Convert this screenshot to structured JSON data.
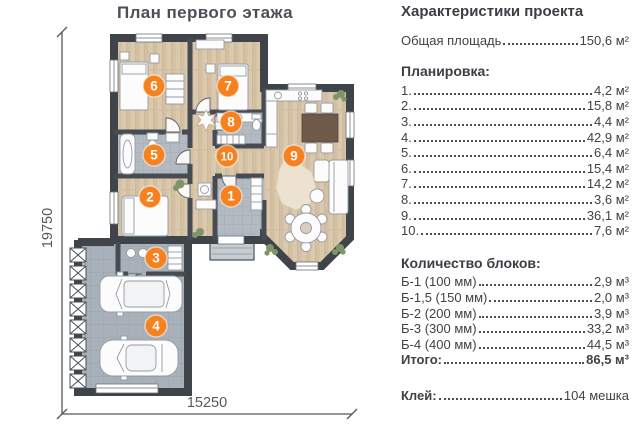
{
  "title": "План первого этажа",
  "dimension_height": "19750",
  "dimension_width": "15250",
  "plan": {
    "rooms": [
      {
        "n": "1",
        "area": "4,2 м²"
      },
      {
        "n": "2",
        "area": "15,8 м²"
      },
      {
        "n": "3",
        "area": "4,4 м²"
      },
      {
        "n": "4",
        "area": "42,9 м²"
      },
      {
        "n": "5",
        "area": "6,4 м²"
      },
      {
        "n": "6",
        "area": "15,4 м²"
      },
      {
        "n": "7",
        "area": "14,2 м²"
      },
      {
        "n": "8",
        "area": "3,6 м²"
      },
      {
        "n": "9",
        "area": "36,1 м²"
      },
      {
        "n": "10",
        "area": "7,6 м²"
      }
    ]
  },
  "specs": {
    "header": "Характеристики проекта",
    "total_area_label": "Общая площадь",
    "total_area_value": "150,6 м²",
    "layout_header": "Планировка:",
    "blocks_header": "Количество блоков:",
    "blocks": [
      {
        "label": "Б-1 (100 мм)",
        "value": "2,9 м³"
      },
      {
        "label": "Б-1,5 (150 мм)",
        "value": "2,0 м³"
      },
      {
        "label": "Б-2 (200 мм)",
        "value": "3,9 м³"
      },
      {
        "label": "Б-3 (300 мм)",
        "value": "33,2 м³"
      },
      {
        "label": "Б-4 (400 мм)",
        "value": "44,5 м³"
      }
    ],
    "totals_label": "Итого:",
    "totals_value": "86,5 м³",
    "glue_label": "Клей:",
    "glue_value": "104 мешка"
  },
  "colors": {
    "accent": "#f5821f",
    "wall": "#3f444b",
    "wood": "#dbc9ae",
    "tile": "#b3bac2",
    "garage_tile": "#a8b1ba",
    "text": "#3f4347"
  }
}
